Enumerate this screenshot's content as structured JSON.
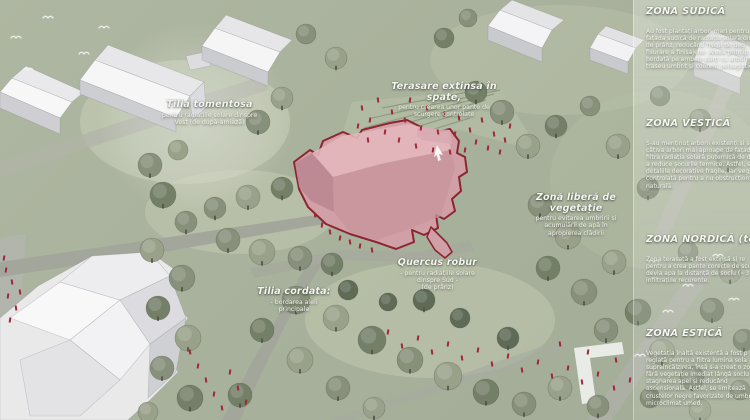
{
  "map": {
    "annotations": [
      {
        "title": "Tilia tomentosa",
        "subtitle": "pentru radiațiile solare dinspre\nVest (de după-amiază)"
      },
      {
        "title": "Terasare extinsă în\nspate,",
        "subtitle": "pentru crearea unor pante de\nscurgere controlate"
      },
      {
        "title": "Zonă liberă de\nvegetație",
        "subtitle": "pentru evitarea umbririi și\nacumulării de apă în\napropierea clădirii"
      },
      {
        "title": "Quercus robur",
        "subtitle": "- pentru radiațiile solare\ndinspre Sud -\n(de prânz)"
      },
      {
        "title": "Tilia cordata:",
        "subtitle": "- bordarea aleii\nprincipale"
      }
    ]
  },
  "legend_panel": {
    "sections": [
      {
        "heading": "ZONA SUDICĂ",
        "body": "Au fost plantați arbori mari pentru\nfațada sudică de radiația solară direc\nde prânz, reducând riscul de deg\nfisurare a finisajelor. Aleea princip\nbordată pe ambele părți cu arbori\ntraseu umbrit și coerent peisagistic."
      },
      {
        "heading": "ZONA VESTICĂ",
        "body": "S-au menținut arborii existenți și s-a\ncâțiva arbori mai aproape de fațad\nfiltra radiația solară puternică de după\na reduce șocurile termice. Astfel, se\ndetaliile decorative fragile, iar veg\ncontrolată pentru a nu obstrucționa\nnaturală."
      },
      {
        "heading": "ZONA NORDICĂ (terasată)",
        "body": "Zona terasată a fost extinsă și re\npentru a crea pante corecte de scu\ndevia apa la distanță de soclu (~3 m)\ninfiltrațiile recurente."
      },
      {
        "heading": "ZONA ESTICĂ",
        "body": "Vegetația înaltă existentă a fost p\nreglată pentru a filtra lumina sola\nsupraîncălzirea, însă s-a creat o zo\nfără vegetație imediat lângă soclu\nstagnarea apei și reducând\nascensională. Astfel, se limitează\ncrustelor negre favorizate de umbrire\nmicroclimat umed."
      }
    ]
  },
  "colors": {
    "background_sage": "#a9b29c",
    "lawn_light": "#c7cdb6",
    "path_gray": "#a2a69b",
    "tree_green": "#7f8a71",
    "building_white": "#f2f2f4",
    "highlight_fill": "#d3a0a7",
    "highlight_outline": "#8c1c2b",
    "people_red": "#9f2738",
    "text_white": "#f6f6f1"
  }
}
